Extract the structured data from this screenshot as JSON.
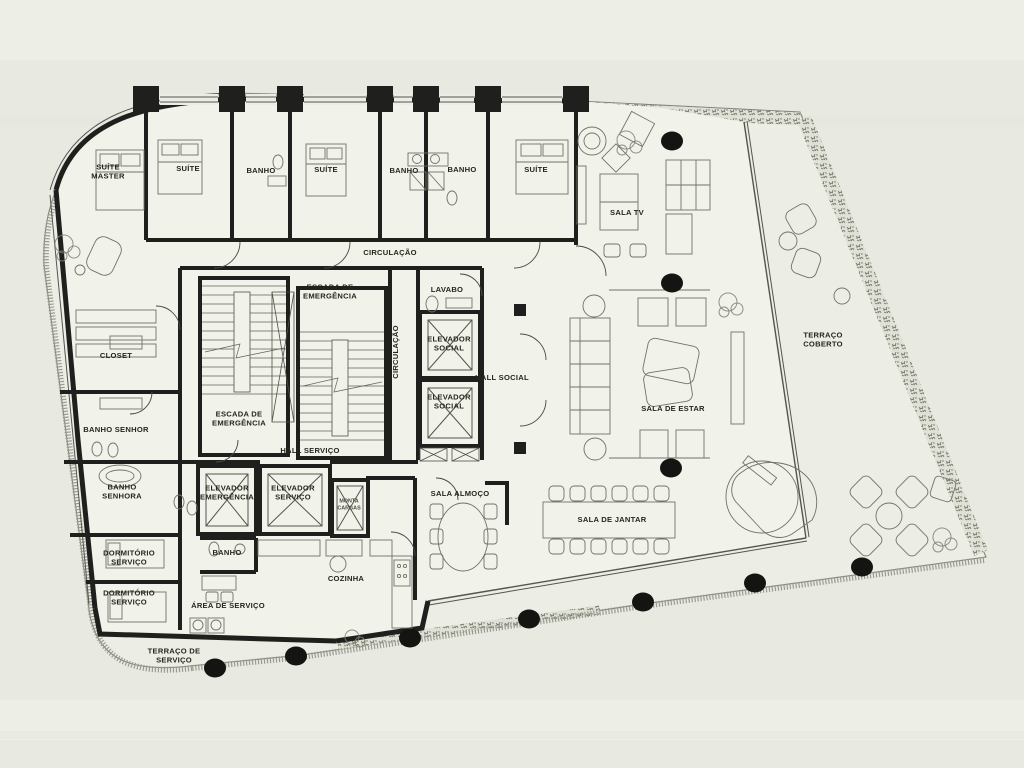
{
  "document": {
    "kind": "architectural floor plan"
  },
  "colors": {
    "bg": "#e8e9e1",
    "paper": "#ecede4",
    "floor": "#f1f2e9",
    "wall": "#1f1f1d",
    "hedge": "#717866",
    "label": "#26261f",
    "column": "#141412"
  },
  "rooms": [
    {
      "name": "suite-master",
      "label": "SUÍTE\nMASTER",
      "x": 108,
      "y": 174
    },
    {
      "name": "suite-2",
      "label": "SUÍTE",
      "x": 188,
      "y": 171
    },
    {
      "name": "banho-1",
      "label": "BANHO",
      "x": 261,
      "y": 173
    },
    {
      "name": "suite-3",
      "label": "SUÍTE",
      "x": 326,
      "y": 172
    },
    {
      "name": "banho-2",
      "label": "BANHO",
      "x": 404,
      "y": 173
    },
    {
      "name": "banho-3",
      "label": "BANHO",
      "x": 462,
      "y": 172
    },
    {
      "name": "suite-4",
      "label": "SUÍTE",
      "x": 536,
      "y": 172
    },
    {
      "name": "sala-tv",
      "label": "SALA TV",
      "x": 627,
      "y": 215
    },
    {
      "name": "circulacao",
      "label": "CIRCULAÇÃO",
      "x": 390,
      "y": 255
    },
    {
      "name": "escada-emergencia-1",
      "label": "ESCADA DE\nEMERGÊNCIA",
      "x": 330,
      "y": 294
    },
    {
      "name": "lavabo",
      "label": "LAVABO",
      "x": 447,
      "y": 292
    },
    {
      "name": "circulacao-vertical",
      "label": "CIRCULAÇÃO",
      "x": 398,
      "y": 352,
      "rotate": -90
    },
    {
      "name": "elevador-social-1",
      "label": "ELEVADOR\nSOCIAL",
      "x": 449,
      "y": 346
    },
    {
      "name": "elevador-social-2",
      "label": "ELEVADOR\nSOCIAL",
      "x": 449,
      "y": 404
    },
    {
      "name": "hall-social",
      "label": "HALL SOCIAL",
      "x": 502,
      "y": 380
    },
    {
      "name": "closet",
      "label": "CLOSET",
      "x": 116,
      "y": 358
    },
    {
      "name": "escada-emergencia-2",
      "label": "ESCADA DE\nEMERGÊNCIA",
      "x": 239,
      "y": 421
    },
    {
      "name": "banho-senhor",
      "label": "BANHO SENHOR",
      "x": 116,
      "y": 432
    },
    {
      "name": "banho-senhora",
      "label": "BANHO\nSENHORA",
      "x": 122,
      "y": 494
    },
    {
      "name": "hall-servico",
      "label": "HALL SERVIÇO",
      "x": 310,
      "y": 453
    },
    {
      "name": "elevador-emergencia",
      "label": "ELEVADOR\nEMERGÊNCIA",
      "x": 227,
      "y": 495
    },
    {
      "name": "elevador-servico",
      "label": "ELEVADOR\nSERVIÇO",
      "x": 293,
      "y": 495
    },
    {
      "name": "monta-cargas",
      "label": "MONTA\nCARGAS",
      "x": 349,
      "y": 506,
      "small": true
    },
    {
      "name": "sala-de-estar",
      "label": "SALA DE ESTAR",
      "x": 673,
      "y": 411
    },
    {
      "name": "terraco-coberto",
      "label": "TERRAÇO\nCOBERTO",
      "x": 823,
      "y": 342
    },
    {
      "name": "sala-almoco",
      "label": "SALA ALMOÇO",
      "x": 460,
      "y": 496
    },
    {
      "name": "sala-de-jantar",
      "label": "SALA DE JANTAR",
      "x": 612,
      "y": 522
    },
    {
      "name": "banho-servico",
      "label": "BANHO",
      "x": 227,
      "y": 555
    },
    {
      "name": "cozinha",
      "label": "COZINHA",
      "x": 346,
      "y": 581
    },
    {
      "name": "dormitorio-servico-1",
      "label": "DORMITÓRIO\nSERVIÇO",
      "x": 129,
      "y": 560
    },
    {
      "name": "dormitorio-servico-2",
      "label": "DORMITÓRIO\nSERVIÇO",
      "x": 129,
      "y": 600
    },
    {
      "name": "area-de-servico",
      "label": "ÁREA DE SERVIÇO",
      "x": 228,
      "y": 608
    },
    {
      "name": "terraco-de-servico",
      "label": "TERRAÇO DE\nSERVIÇO",
      "x": 174,
      "y": 658
    }
  ],
  "columns": [
    [
      672,
      141
    ],
    [
      672,
      283
    ],
    [
      671,
      468
    ],
    [
      529,
      619
    ],
    [
      643,
      602
    ],
    [
      755,
      583
    ],
    [
      862,
      567
    ],
    [
      410,
      638
    ],
    [
      296,
      656
    ],
    [
      215,
      668
    ]
  ]
}
